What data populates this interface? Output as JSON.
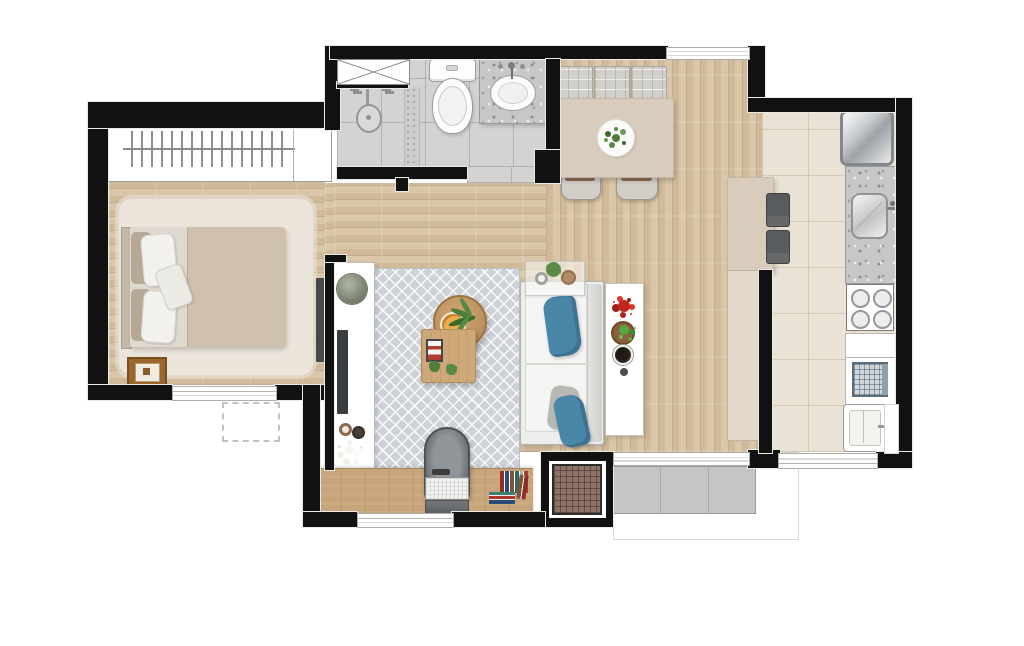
{
  "scene": {
    "type": "residential apartment floor plan, top-down 3D render, no text labels",
    "rooms": [
      {
        "label": "Bedroom",
        "items": [
          "wardrobe with hanging rail",
          "double bed with pillows",
          "shag area rug",
          "nightstand",
          "wall-mounted TV",
          "window",
          "AC unit dashed outline"
        ]
      },
      {
        "label": "Bathroom",
        "items": [
          "shower area",
          "shower niche",
          "toilet",
          "granite vanity with oval sink"
        ]
      },
      {
        "label": "Dining area",
        "items": [
          "dining table",
          "three seat cushions",
          "two chairs",
          "plant centerpiece",
          "window"
        ]
      },
      {
        "label": "Kitchen",
        "items": [
          "refrigerator",
          "granite counter with sink",
          "four-burner cooktop",
          "white counter",
          "washing machine",
          "laundry tub",
          "bar counter with cabinet",
          "two bar stools",
          "service door",
          "window"
        ]
      },
      {
        "label": "Living room",
        "items": [
          "TV console with plants",
          "TV",
          "patterned rug",
          "round coffee table with plant and plate",
          "wood side table with tray and plants",
          "glass console with plants",
          "sofa",
          "blue and gray cushions",
          "shelf with flowers, plant and bowls",
          "desk",
          "laptop",
          "books",
          "office chair",
          "window"
        ]
      },
      {
        "label": "Balcony service area",
        "items": [
          "barbecue grill",
          "concrete bench",
          "sliding glass door"
        ]
      }
    ],
    "colors": {
      "wall": "#111111",
      "wood": "#d8c3a4",
      "deskWood": "#c8a47a",
      "tileBath": "#d3d3d2",
      "tileKitchen": "#eae3d5",
      "rugLiving": "#cdd2d8",
      "rugBedroom": "#ebe5dc",
      "furnBeige": "#d9ccbd",
      "sofaWhite": "#ededeb",
      "pillowBlue": "#4a86a8",
      "graniteGray": "#c7c7c7",
      "darkGray": "#595c5e",
      "grillBrown": "#8e7266",
      "slabGray": "#c5c6c3",
      "plantGreen": "#4f7d3c",
      "flowerRed": "#c0271f"
    }
  }
}
